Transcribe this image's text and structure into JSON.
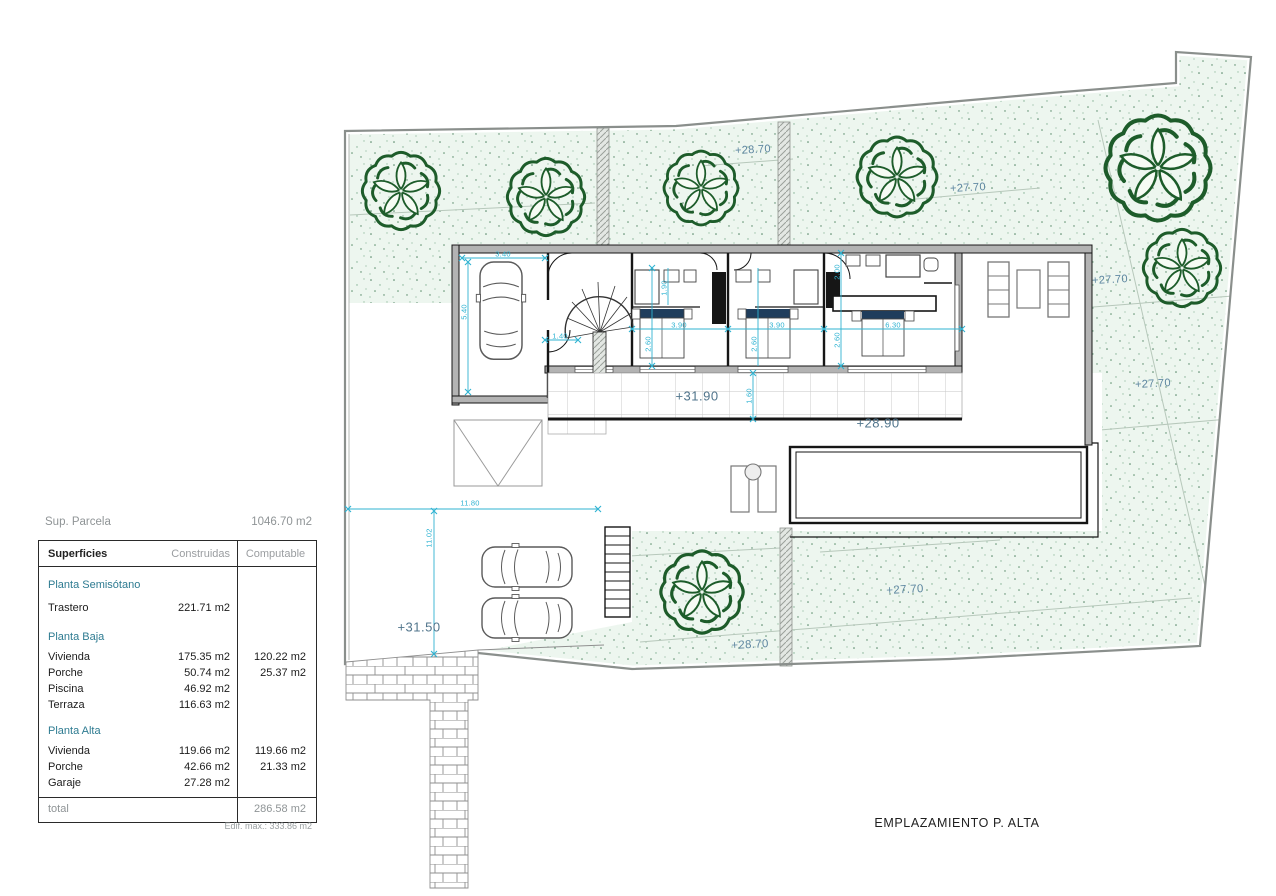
{
  "title": "EMPLAZAMIENTO P. ALTA",
  "parcel": {
    "label": "Sup. Parcela",
    "area": "1046.70 m2",
    "edif_max": "Edif. max.: 333.86 m2"
  },
  "table": {
    "col_superficies": "Superficies",
    "col_construidas": "Construidas",
    "col_computable": "Computable",
    "sections": [
      {
        "name": "Planta Semisótano",
        "rows": [
          {
            "label": "Trastero",
            "construida": "221.71 m2",
            "computable": ""
          }
        ]
      },
      {
        "name": "Planta Baja",
        "rows": [
          {
            "label": "Vivienda",
            "construida": "175.35 m2",
            "computable": "120.22 m2"
          },
          {
            "label": "Porche",
            "construida": "50.74 m2",
            "computable": "25.37 m2"
          },
          {
            "label": "Piscina",
            "construida": "46.92 m2",
            "computable": ""
          },
          {
            "label": "Terraza",
            "construida": "116.63 m2",
            "computable": ""
          }
        ]
      },
      {
        "name": "Planta Alta",
        "rows": [
          {
            "label": "Vivienda",
            "construida": "119.66 m2",
            "computable": "119.66 m2"
          },
          {
            "label": "Porche",
            "construida": "42.66 m2",
            "computable": "21.33 m2"
          },
          {
            "label": "Garaje",
            "construida": "27.28 m2",
            "computable": ""
          }
        ]
      }
    ],
    "total_label": "total",
    "total_value": "286.58 m2"
  },
  "elev": {
    "top_mid": "+28.70",
    "top_right": "+27.70",
    "right_upper": "+27.70",
    "right_lower": "+27.70",
    "terrace_upper": "+31.90",
    "terrace_lower": "+28.90",
    "driveway": "+31.50",
    "bottom_left": "+28.70",
    "bottom_right": "+27.70"
  },
  "dims": {
    "garage_w": "3.40",
    "garage_d": "5.40",
    "hall": "1.40",
    "bath1": "1.90",
    "bed1_w": "3.90",
    "bed2_w": "3.90",
    "master_w": "6.30",
    "bed1_d": "2.60",
    "bed2_d": "2.60",
    "master_top": "2.00",
    "master_d": "2.60",
    "porch_d": "1.60",
    "drive_w": "11.80",
    "drive_d": "11.02"
  },
  "colors": {
    "garden_fill": "#edf6ef",
    "tree_green": "#1d5c2a",
    "dimension_cyan": "#2fb3d2",
    "elevation_blue": "#5d86a0",
    "wall_black": "#161616",
    "section_teal": "#2e7b91",
    "boundary_gray": "#8a8f8c",
    "headboard_navy": "#1f3d5c"
  }
}
